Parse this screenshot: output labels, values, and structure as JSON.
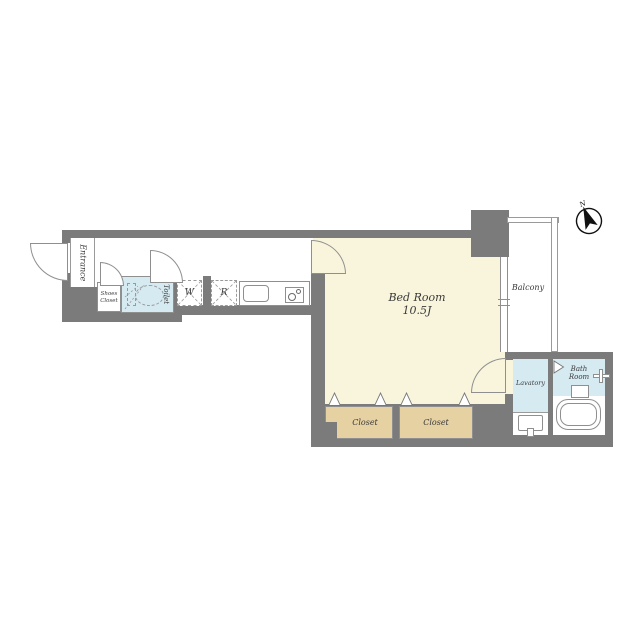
{
  "plan": {
    "type": "apartment-floor-plan",
    "compass": {
      "north_label": "N"
    },
    "rooms": {
      "entrance": {
        "label": "Entrance"
      },
      "shoes_closet": {
        "label": "Shoes Closet"
      },
      "toilet": {
        "label": "Toilet"
      },
      "washer": {
        "label": "W"
      },
      "refrigerator": {
        "label": "R"
      },
      "bedroom": {
        "label": "Bed Room",
        "size": "10.5J"
      },
      "balcony": {
        "label": "Balcony"
      },
      "closet1": {
        "label": "Closet"
      },
      "closet2": {
        "label": "Closet"
      },
      "lavatory": {
        "label": "Lavatory"
      },
      "bathroom": {
        "label": "Bath Room"
      }
    },
    "colors": {
      "wall": "#7b7b7b",
      "bedroom_floor": "#f9f5dc",
      "wet_area_floor": "#d6eaf2",
      "closet_floor": "#e6d1a3",
      "line": "#8f8f8f"
    }
  }
}
